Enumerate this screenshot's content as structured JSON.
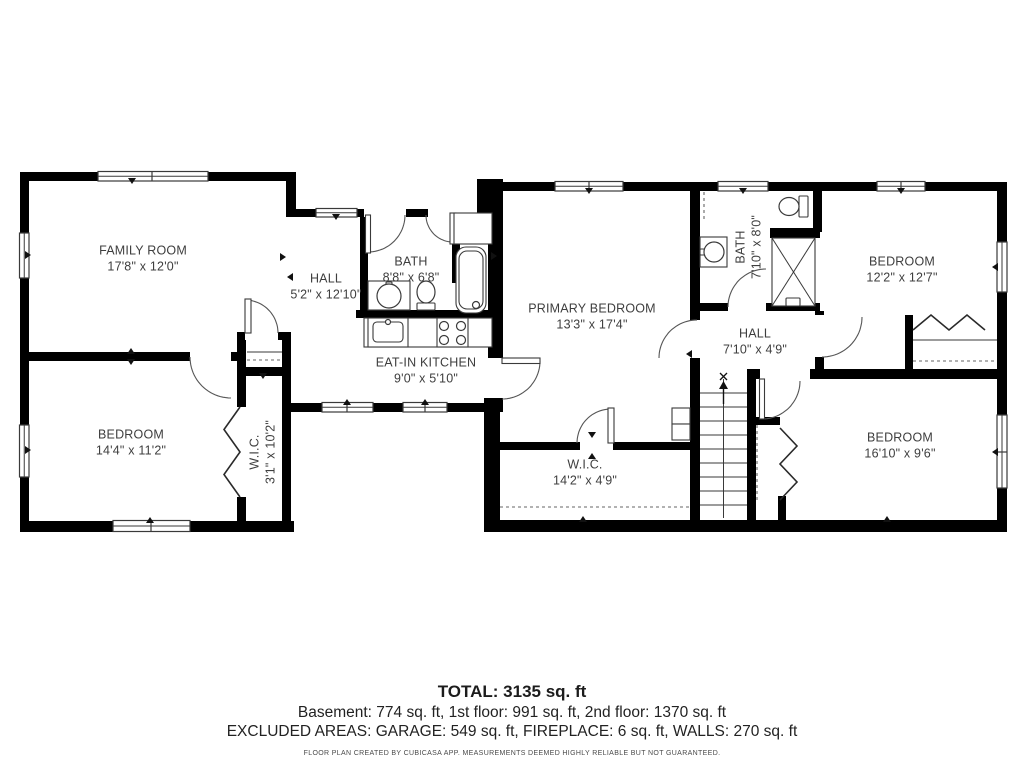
{
  "colors": {
    "wall": "#000000",
    "fixture": "#3a3a3a",
    "label_text": "#3e3e3e"
  },
  "rooms": [
    {
      "id": "family-room",
      "name": "FAMILY ROOM",
      "dims": "17'8\" x 12'0\""
    },
    {
      "id": "hall-left",
      "name": "HALL",
      "dims": "5'2\" x 12'10\""
    },
    {
      "id": "bath-left",
      "name": "BATH",
      "dims": "8'8\" x 6'8\""
    },
    {
      "id": "eat-in-kitchen",
      "name": "EAT-IN KITCHEN",
      "dims": "9'0\" x 5'10\""
    },
    {
      "id": "bedroom-left",
      "name": "BEDROOM",
      "dims": "14'4\" x 11'2\""
    },
    {
      "id": "wic-small",
      "name": "W.I.C.",
      "dims": "3'1\" x 10'2\""
    },
    {
      "id": "primary-bedroom",
      "name": "PRIMARY BEDROOM",
      "dims": "13'3\" x 17'4\""
    },
    {
      "id": "bath-right",
      "name": "BATH",
      "dims": "7'10\" x 8'0\""
    },
    {
      "id": "hall-right",
      "name": "HALL",
      "dims": "7'10\" x 4'9\""
    },
    {
      "id": "bedroom-top-right",
      "name": "BEDROOM",
      "dims": "12'2\" x 12'7\""
    },
    {
      "id": "wic-large",
      "name": "W.I.C.",
      "dims": "14'2\" x 4'9\""
    },
    {
      "id": "bedroom-bottom-right",
      "name": "BEDROOM",
      "dims": "16'10\" x 9'6\""
    }
  ],
  "footer": {
    "total": "TOTAL: 3135 sq. ft",
    "floors": "Basement: 774 sq. ft, 1st floor: 991 sq. ft, 2nd floor: 1370 sq. ft",
    "excluded": "EXCLUDED AREAS: GARAGE: 549 sq. ft, FIREPLACE: 6 sq. ft, WALLS: 270 sq. ft",
    "disclaimer": "FLOOR PLAN CREATED BY CUBICASA APP. MEASUREMENTS DEEMED HIGHLY RELIABLE BUT NOT GUARANTEED."
  }
}
